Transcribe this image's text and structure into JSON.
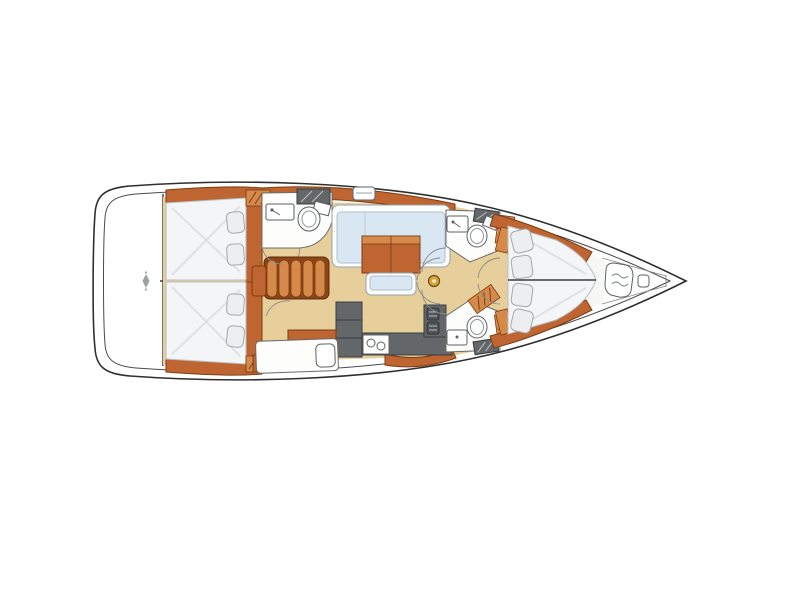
{
  "diagram": {
    "type": "sailing-yacht-interior-floor-plan",
    "orientation": "bow-right-stern-left",
    "areas": [
      "swim-platform-transom",
      "aft-cabin-port-double-berth",
      "aft-cabin-starboard-double-berth",
      "aft-head-port-with-shower",
      "companionway-steps",
      "saloon-l-sofa-port",
      "saloon-table",
      "saloon-bench",
      "mast-post",
      "galley-starboard",
      "chart-table-starboard-aft",
      "forward-head-port",
      "forward-head-starboard",
      "forward-owner-cabin-v-berth",
      "anchor-locker-bow"
    ],
    "counts": {
      "cabins": 3,
      "heads": 3,
      "companionway_steps": 5,
      "galley_sinks": 2,
      "stove_burners": 2,
      "aft_cabin_pillows_each": 2,
      "v_berth_pillows": 4
    }
  },
  "palette": {
    "floor": "#e7cf9b",
    "wood": "#bf6532",
    "wood-dark": "#7c3c12",
    "wood-light": "#d68a4a",
    "mattress": "#f3f5f6",
    "sofa": "#d9e7f2",
    "counter": "#63676a",
    "hull-line": "#2f2f2f",
    "gold": "#d8a33c"
  }
}
